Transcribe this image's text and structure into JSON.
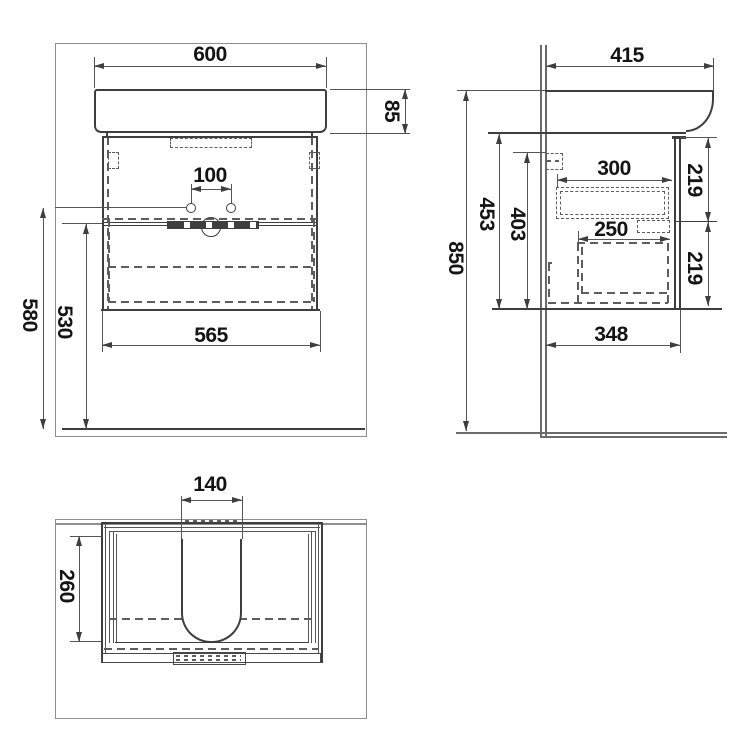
{
  "views": {
    "front": {
      "dims": {
        "basin_width": "600",
        "basin_height": "85",
        "tap_hole_spacing": "100",
        "tap_height": "580",
        "top_height": "530",
        "cabinet_width": "565"
      }
    },
    "side": {
      "dims": {
        "basin_depth": "415",
        "total_height": "850",
        "underbasin_height": "453",
        "cabinet_height": "403",
        "upper_drawer_depth": "300",
        "upper_front_height": "219",
        "lower_drawer_depth": "250",
        "lower_front_height": "219",
        "cabinet_depth": "348"
      }
    },
    "plan": {
      "dims": {
        "cutout_width": "140",
        "cutout_depth": "260"
      }
    }
  }
}
